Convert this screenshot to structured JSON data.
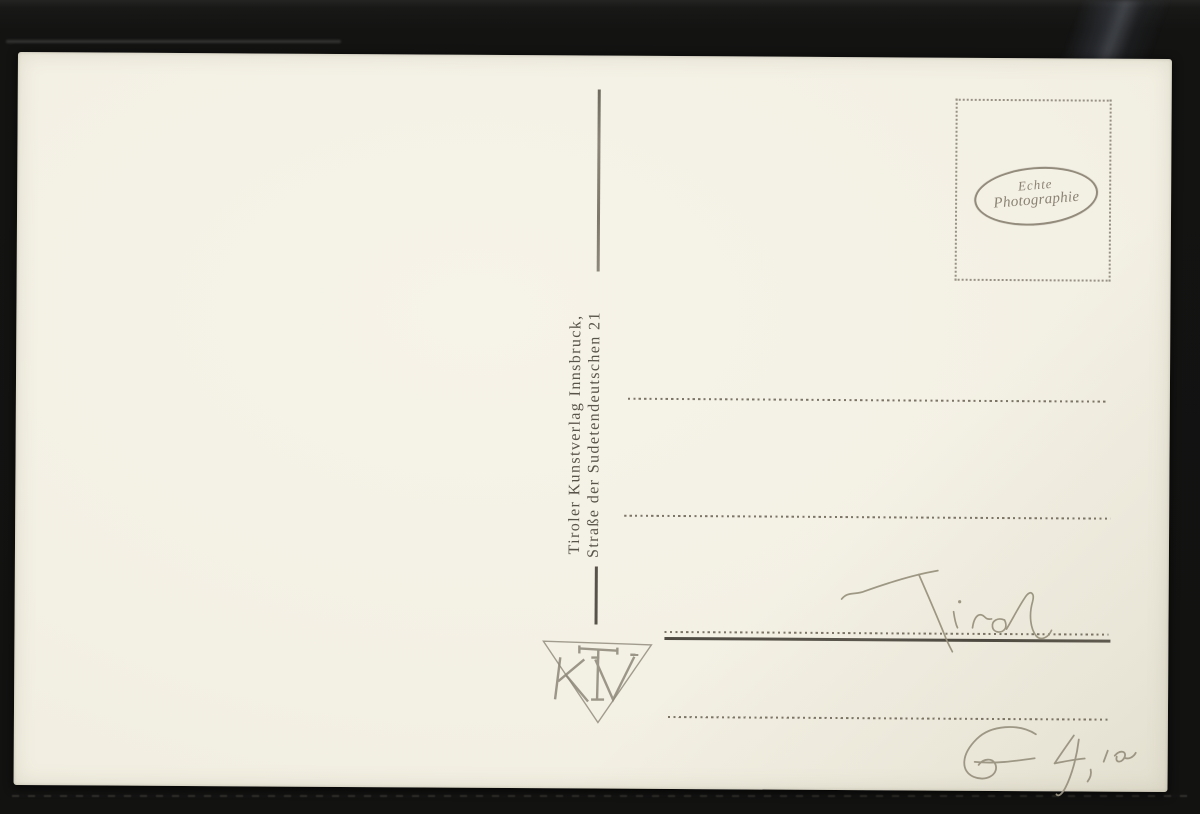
{
  "colors": {
    "background": "#131312",
    "card": "#f2efe2",
    "printed_ink": "#6b6455",
    "stamp_ink": "#847d6e",
    "pencil": "#9a9482"
  },
  "card": {
    "publisher_line1": "Tiroler Kunstverlag Innsbruck,",
    "publisher_line2": "Straße der Sudetendeutschen 21",
    "stamp_box": {
      "line1": "Echte",
      "line2": "Photographie"
    },
    "monogram_letters": "TKV",
    "handwriting_title": "Tirol",
    "handwriting_price": "€ 4,10",
    "ruled_line_count": 4
  }
}
